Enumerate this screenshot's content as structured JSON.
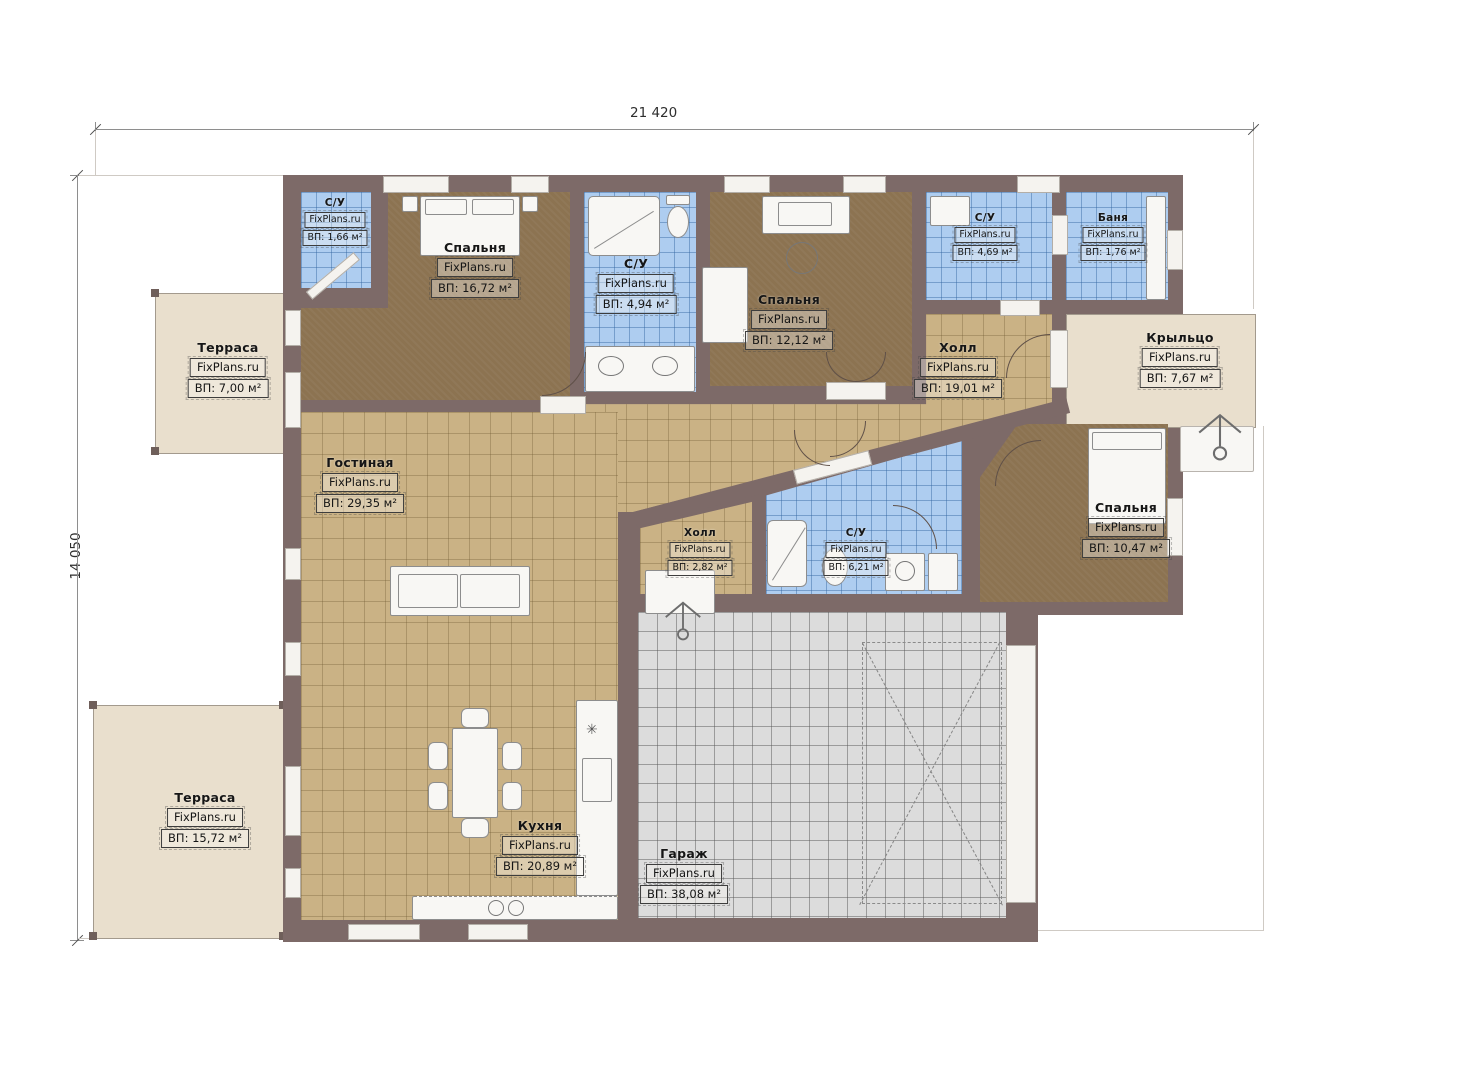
{
  "plan": {
    "title": "Floor plan",
    "dimensions": {
      "top": "21 420",
      "left": "14 050"
    },
    "brand": "FixPlans.ru"
  },
  "colors": {
    "wall": "#7d6a68",
    "bedroom_floor": "#8c7351",
    "tile_floor": "#cab285",
    "wet_floor": "#aecdf0",
    "garage_floor": "#dcdcdc",
    "terrace_floor": "#e9dfcd"
  },
  "rooms": [
    {
      "key": "wc-top-left",
      "name": "С/У",
      "brand": "FixPlans.ru",
      "area": "ВП: 1,66 м²"
    },
    {
      "key": "bedroom-1",
      "name": "Спальня",
      "brand": "FixPlans.ru",
      "area": "ВП: 16,72 м²"
    },
    {
      "key": "wc-shower",
      "name": "С/У",
      "brand": "FixPlans.ru",
      "area": "ВП: 4,94 м²"
    },
    {
      "key": "bedroom-2",
      "name": "Спальня",
      "brand": "FixPlans.ru",
      "area": "ВП: 12,12 м²"
    },
    {
      "key": "wc-right",
      "name": "С/У",
      "brand": "FixPlans.ru",
      "area": "ВП: 4,69 м²"
    },
    {
      "key": "banya",
      "name": "Баня",
      "brand": "FixPlans.ru",
      "area": "ВП: 1,76 м²"
    },
    {
      "key": "hall-main",
      "name": "Холл",
      "brand": "FixPlans.ru",
      "area": "ВП: 19,01 м²"
    },
    {
      "key": "porch",
      "name": "Крыльцо",
      "brand": "FixPlans.ru",
      "area": "ВП: 7,67 м²"
    },
    {
      "key": "terrace-top",
      "name": "Терраса",
      "brand": "FixPlans.ru",
      "area": "ВП: 7,00 м²"
    },
    {
      "key": "living",
      "name": "Гостиная",
      "brand": "FixPlans.ru",
      "area": "ВП: 29,35 м²"
    },
    {
      "key": "hall-small",
      "name": "Холл",
      "brand": "FixPlans.ru",
      "area": "ВП: 2,82 м²"
    },
    {
      "key": "wc-center",
      "name": "С/У",
      "brand": "FixPlans.ru",
      "area": "ВП: 6,21 м²"
    },
    {
      "key": "bedroom-3",
      "name": "Спальня",
      "brand": "FixPlans.ru",
      "area": "ВП: 10,47 м²"
    },
    {
      "key": "terrace-bottom",
      "name": "Терраса",
      "brand": "FixPlans.ru",
      "area": "ВП: 15,72 м²"
    },
    {
      "key": "kitchen",
      "name": "Кухня",
      "brand": "FixPlans.ru",
      "area": "ВП: 20,89 м²"
    },
    {
      "key": "garage",
      "name": "Гараж",
      "brand": "FixPlans.ru",
      "area": "ВП: 38,08 м²"
    }
  ]
}
